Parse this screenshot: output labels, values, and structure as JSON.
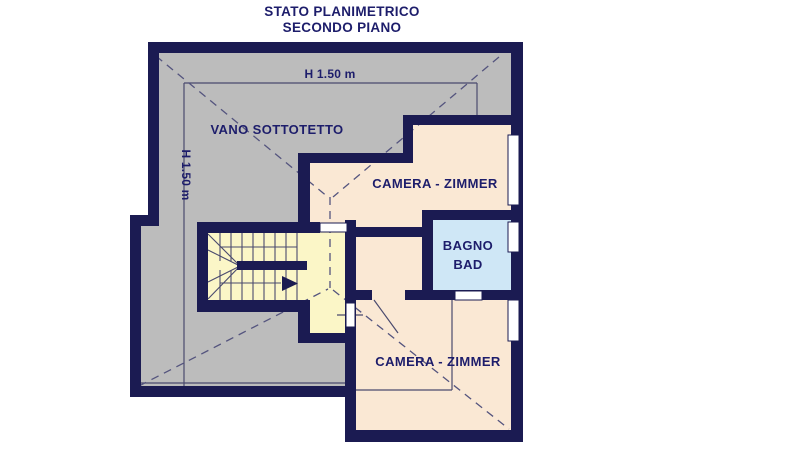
{
  "title": {
    "line1": "STATO PLANIMETRICO",
    "line2": "SECONDO PIANO"
  },
  "labels": {
    "attic": "VANO SOTTOTETTO",
    "height_top": "H 1.50 m",
    "height_left": "H 1.50 m",
    "bedroom_upper": "CAMERA - ZIMMER",
    "bedroom_lower": "CAMERA - ZIMMER",
    "bathroom_line1": "BAGNO",
    "bathroom_line2": "BAD"
  },
  "colors": {
    "wall": "#1b1b52",
    "attic_gray": "#bcbcbc",
    "room_beige": "#fae8d4",
    "stair_yellow": "#fbf6c7",
    "bath_blue": "#cfe7f6",
    "text": "#1d1d6b",
    "thin_line": "#4a4a6e",
    "dashed_line": "#54547e",
    "opening_white": "#ffffff"
  }
}
